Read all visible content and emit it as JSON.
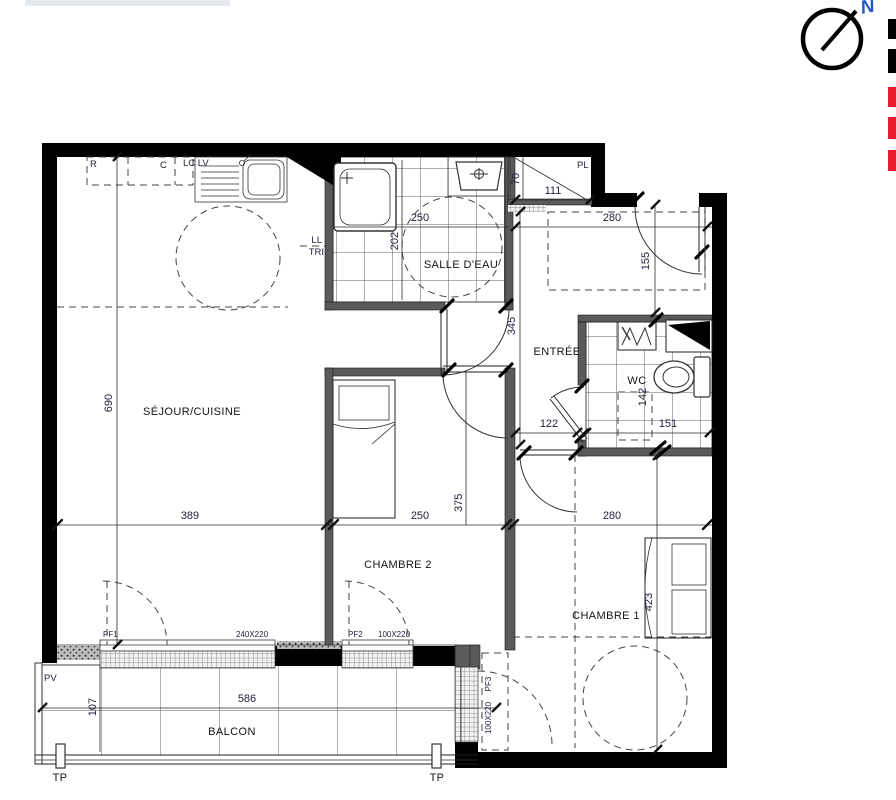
{
  "plan": {
    "type": "apartment-floor-plan",
    "labels": {
      "sejour": "SÉJOUR/CUISINE",
      "salle_deau": "SALLE D'EAU",
      "entree": "ENTRÉE",
      "wc": "WC",
      "chambre2": "CHAMBRE 2",
      "chambre1": "CHAMBRE 1",
      "balcon": "BALCON",
      "pl": "PL",
      "r": "R",
      "c": "C",
      "lclv": "LC LV",
      "ll": "LL",
      "tri": "TRI",
      "pv": "PV",
      "tp": "TP",
      "north": "N"
    },
    "windows": {
      "pf1": {
        "label": "PF1",
        "size": "240X220"
      },
      "pf2": {
        "label": "PF2",
        "size": "100X220"
      },
      "pf3": {
        "label": "PF3",
        "size": "100X220"
      }
    },
    "dims": {
      "sejour_h": "690",
      "sejour_w": "389",
      "chambre2_w": "250",
      "aux_375": "375",
      "chambre1_w": "280",
      "hall_h": "345",
      "hall_w": "280",
      "pl_w": "111",
      "pl_d": "70",
      "sde_w": "250",
      "sde_d": "202",
      "right_155": "155",
      "hall_122": "122",
      "wc_w": "151",
      "wc_d": "142",
      "chambre1_h": "423",
      "balcon_w": "586",
      "balcon_d": "107"
    },
    "colors": {
      "wall": "#000000",
      "partition": "#5a5a5a",
      "dim_text": "#20223d",
      "north_blue": "#1d56c8",
      "legend_black": "#000000",
      "legend_red": "#ec1b2e"
    },
    "legend": {
      "items": [
        {
          "color": "#000000"
        },
        {
          "color": "#000000"
        },
        {
          "color": "#ec1b2e"
        },
        {
          "color": "#ec1b2e"
        },
        {
          "color": "#ec1b2e"
        }
      ]
    }
  }
}
